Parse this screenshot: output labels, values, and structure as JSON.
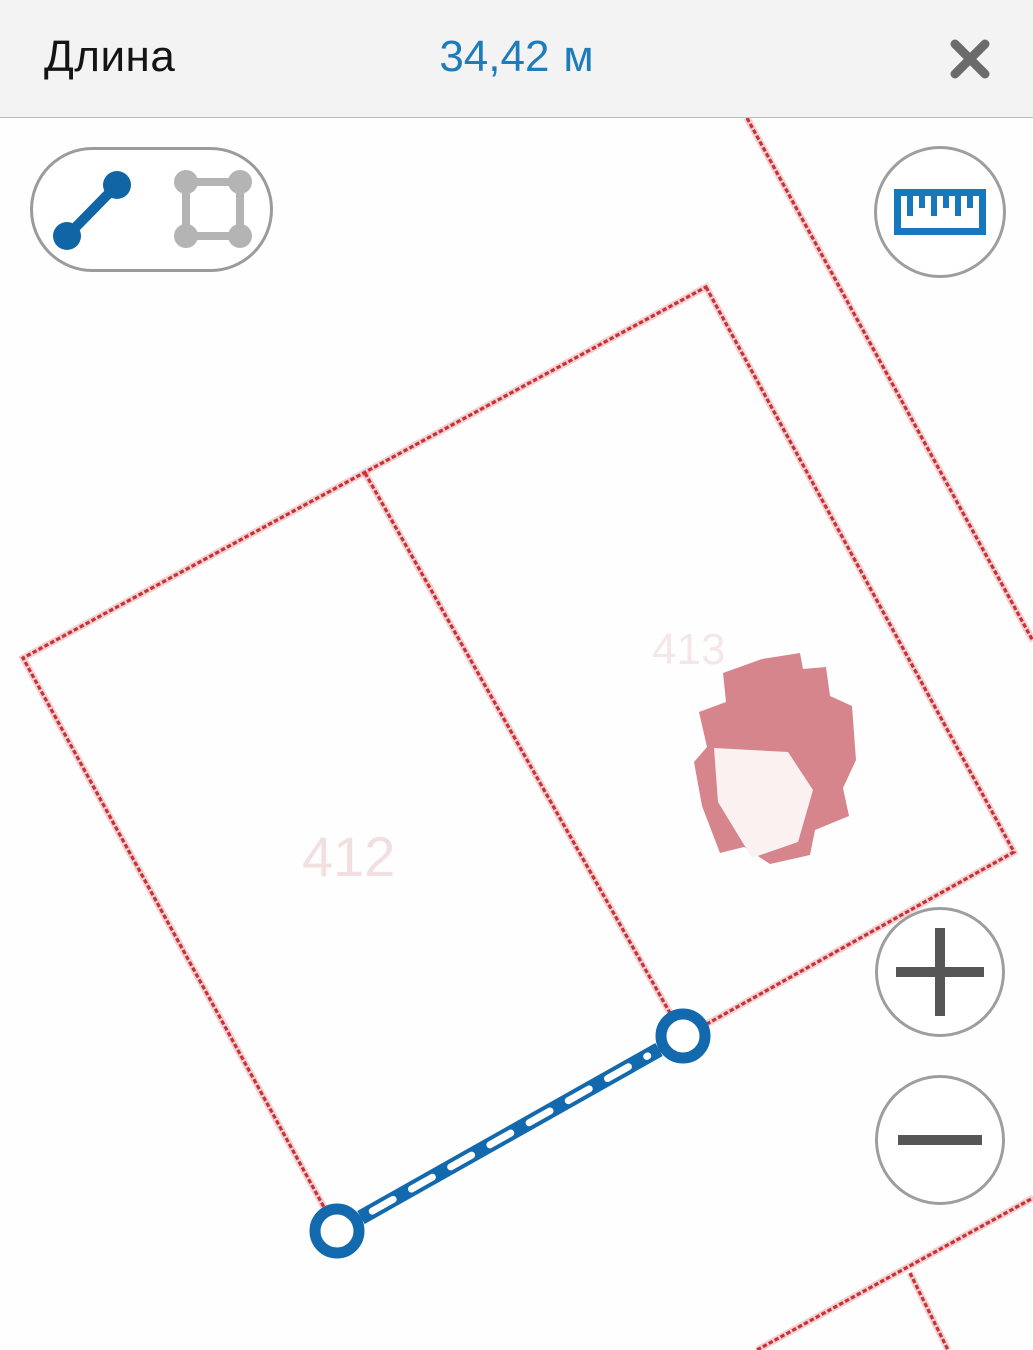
{
  "header": {
    "title": "Длина",
    "value": "34,42",
    "unit": "м",
    "close_label": "✕"
  },
  "toolbar": {
    "line_tool_label": "линия",
    "area_tool_label": "площадь",
    "ruler_label": "измерение"
  },
  "zoom_controls": {
    "zoom_in": "+",
    "zoom_out": "−"
  },
  "colors": {
    "accent_blue": "#1d7cba",
    "measure_blue": "#1269ad",
    "boundary_red": "#c93136",
    "boundary_halo": "rgba(201,49,54,0.22)",
    "building_fill": "#d5858b",
    "building_roof": "#fbf1f1",
    "faint_label_pink": "#e9c6c9",
    "inactive_icon_gray": "#b4b4b4",
    "control_border_gray": "#9b9b9b",
    "plus_minus_gray": "#565656"
  },
  "map": {
    "boundaries": [
      {
        "name": "road-east-boundary",
        "closed": false,
        "points": [
          [
            747,
            118
          ],
          [
            1033,
            641
          ]
        ]
      },
      {
        "name": "main-parcel-outline",
        "closed": true,
        "points": [
          [
            706,
            287
          ],
          [
            1014,
            852
          ],
          [
            337,
            1231
          ],
          [
            23,
            658
          ]
        ]
      },
      {
        "name": "parcel-divider",
        "closed": false,
        "points": [
          [
            365,
            473
          ],
          [
            683,
            1036
          ]
        ]
      },
      {
        "name": "south-east-boundary",
        "closed": false,
        "points": [
          [
            757,
            1350
          ],
          [
            1033,
            1198
          ]
        ]
      },
      {
        "name": "south-east-branch",
        "closed": false,
        "points": [
          [
            910,
            1273
          ],
          [
            948,
            1350
          ]
        ]
      }
    ],
    "building": {
      "outline": [
        [
          762,
          659
        ],
        [
          800,
          653
        ],
        [
          803,
          669
        ],
        [
          826,
          667
        ],
        [
          830,
          696
        ],
        [
          852,
          706
        ],
        [
          856,
          760
        ],
        [
          843,
          788
        ],
        [
          849,
          816
        ],
        [
          815,
          830
        ],
        [
          810,
          855
        ],
        [
          770,
          864
        ],
        [
          744,
          847
        ],
        [
          720,
          853
        ],
        [
          702,
          806
        ],
        [
          694,
          762
        ],
        [
          707,
          747
        ],
        [
          699,
          712
        ],
        [
          726,
          702
        ],
        [
          723,
          673
        ]
      ],
      "roof": [
        [
          714,
          748
        ],
        [
          788,
          752
        ],
        [
          813,
          790
        ],
        [
          798,
          842
        ],
        [
          752,
          858
        ],
        [
          718,
          802
        ]
      ]
    },
    "faint_labels": [
      {
        "text": "412",
        "x": 302,
        "y": 876,
        "size": 56,
        "opacity": 0.55
      },
      {
        "text": "413",
        "x": 652,
        "y": 664,
        "size": 44,
        "opacity": 0.4
      }
    ],
    "measurement": {
      "start": [
        337,
        1231
      ],
      "end": [
        683,
        1036
      ],
      "band_width": 15,
      "dash_width": 7,
      "dash_pattern": "24 21",
      "endpoint_radius": 22,
      "endpoint_stroke": 11
    }
  }
}
